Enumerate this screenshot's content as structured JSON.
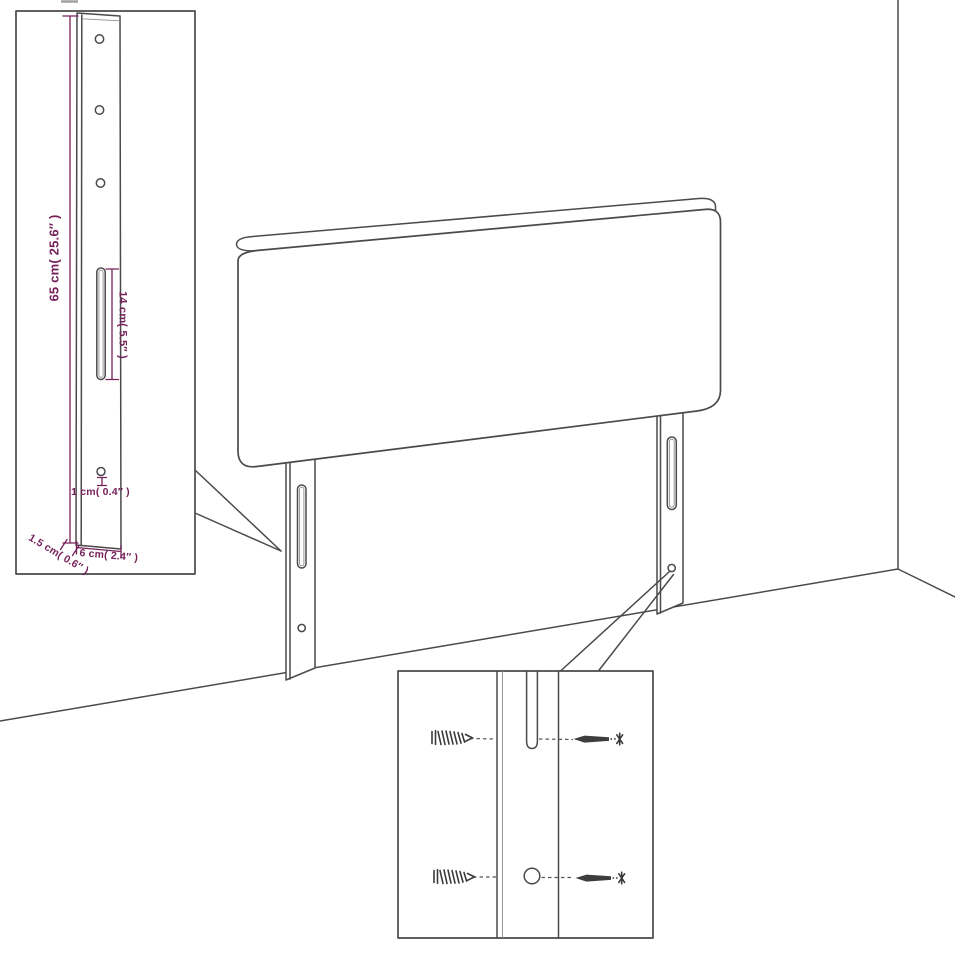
{
  "page": {
    "title": "Headboard mounting dimension diagram",
    "background": "#ffffff"
  },
  "colors": {
    "outline": "#4a4a4a",
    "dimension_accent": "#76215a",
    "inner_detail": "#8d8d8d",
    "screw_dark": "#3a3a3a"
  },
  "main_drawing": {
    "subject": "headboard-with-two-mounting-legs-in-room-corner"
  },
  "leg_detail_inset": {
    "labels": {
      "height": "65 cm( 25.6″ )",
      "slot_length": "14 cm( 5.5″ )",
      "hole_diameter": "1 cm( 0.4″ )",
      "thickness": "1.5 cm( 0.6″ )",
      "width": "6 cm( 2.4″ )"
    }
  },
  "mounting_detail_inset": {
    "icons": [
      "wood-screw-icon",
      "wall-screw-icon",
      "slot-cutout",
      "round-hole"
    ]
  }
}
